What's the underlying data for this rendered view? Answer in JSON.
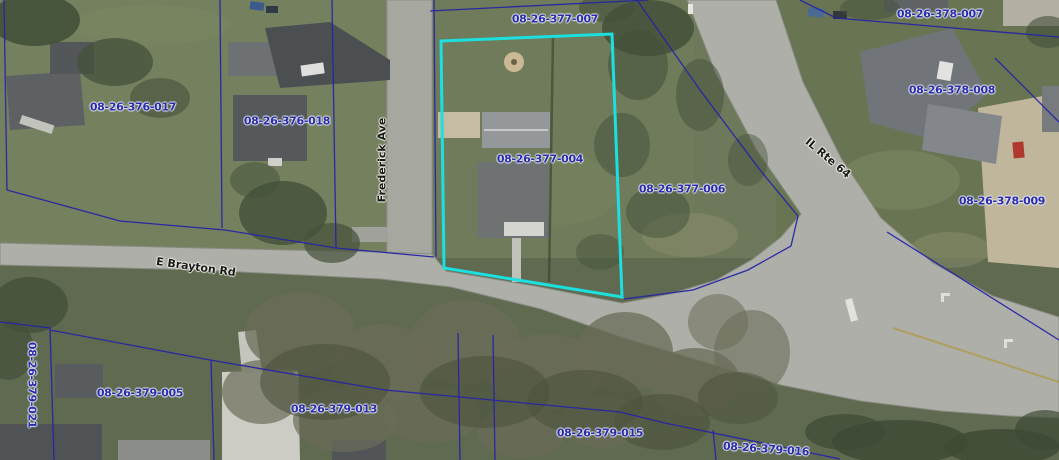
{
  "map": {
    "highlighted_parcel": "08-26-377-004",
    "parcel_labels": {
      "p377_007": "08-26-377-007",
      "p378_007": "08-26-378-007",
      "p376_017": "08-26-376-017",
      "p376_018": "08-26-376-018",
      "p378_008": "08-26-378-008",
      "p377_004": "08-26-377-004",
      "p377_006": "08-26-377-006",
      "p378_009": "08-26-378-009",
      "p379_021": "08-26-379-021",
      "p379_005": "08-26-379-005",
      "p379_013": "08-26-379-013",
      "p379_015": "08-26-379-015",
      "p379_016": "08-26-379-016"
    },
    "road_labels": {
      "frederick": "Frederick Ave",
      "brayton": "E Brayton Rd",
      "il64": "IL Rte 64"
    },
    "colors": {
      "parcel_line": "#2525a5",
      "highlight_outline": "#1ce0e0",
      "parcel_label_text": "#2b2ba8",
      "road_label_text": "#1a1a1a"
    }
  }
}
